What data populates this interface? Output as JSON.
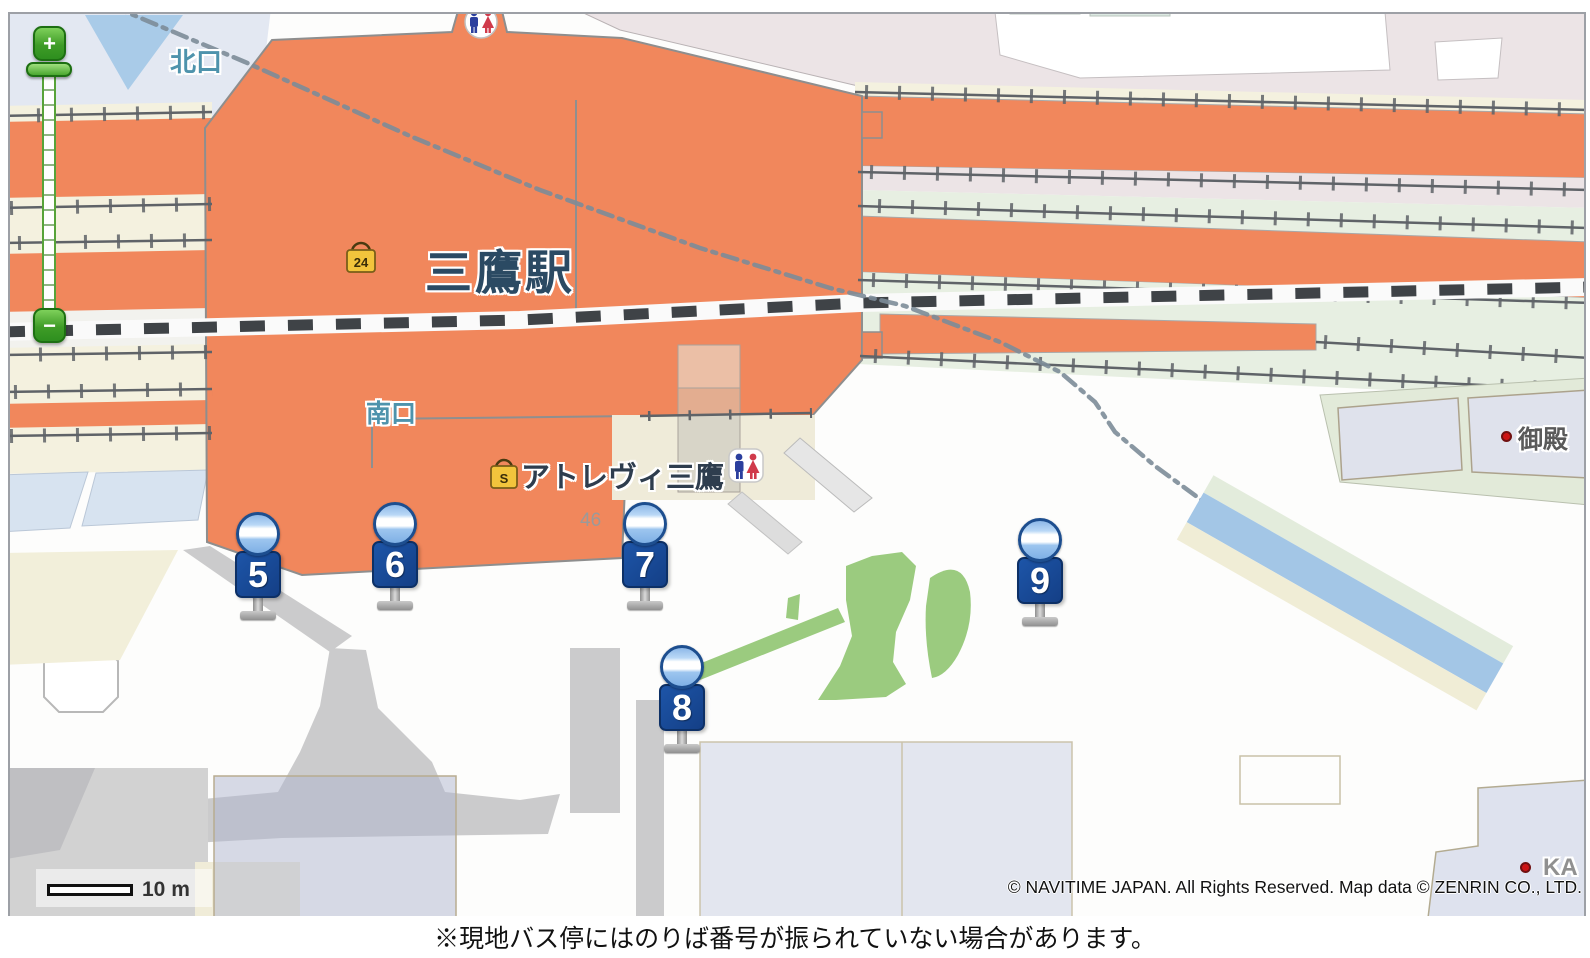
{
  "map": {
    "labels": {
      "station": "三鷹駅",
      "north_exit": "北口",
      "south_exit": "南口",
      "atrevie": "アトレヴィ三鷹",
      "parcel_46": "46",
      "goten": "御殿",
      "ka_partial": "KA",
      "locker_24": "24",
      "locker_s": "S"
    },
    "colors": {
      "station_orange": "#F1875C",
      "bus_sign_blue": "#17448F",
      "bus_icon_blue": "#8FC0EE",
      "park_green": "#9BCB7F",
      "canal_blue": "#A3C6E6",
      "zoom_green": "#3F9C27",
      "label_teal": "#4E93AC"
    }
  },
  "bus_stops": [
    {
      "number": "5",
      "x": 258,
      "y": 512
    },
    {
      "number": "6",
      "x": 395,
      "y": 502
    },
    {
      "number": "7",
      "x": 645,
      "y": 502
    },
    {
      "number": "8",
      "x": 682,
      "y": 645
    },
    {
      "number": "9",
      "x": 1040,
      "y": 518
    }
  ],
  "zoom_control": {
    "plus": "+",
    "minus": "−"
  },
  "scale_bar": {
    "label": "10 m"
  },
  "copyright": "© NAVITIME JAPAN. All Rights Reserved. Map data © ZENRIN CO., LTD.",
  "caption": "※現地バス停にはのりば番号が振られていない場合があります。"
}
